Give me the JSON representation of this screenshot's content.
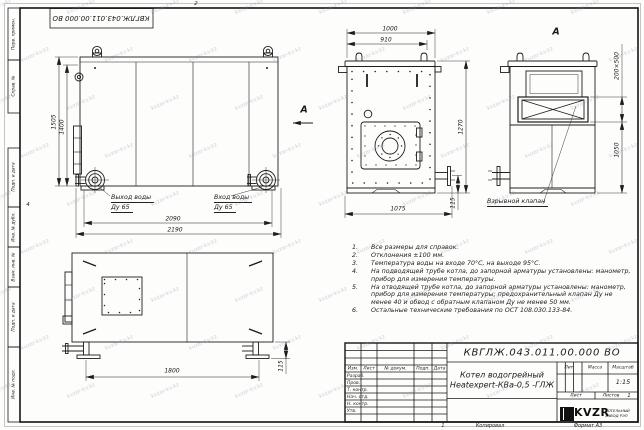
{
  "sheet": {
    "zone_top": "2",
    "zone_left": "4",
    "fold_mark": "1",
    "copy_label": "Копировал",
    "format_label": "Формат А3",
    "stamp_top": "КВГЛЖ.043.011.00.000 ВО",
    "watermark": "kvzar-kv.kz"
  },
  "frame_left": {
    "boxes_top": [
      "Перв. примен.",
      "Справ. №"
    ],
    "boxes_bottom": [
      "Подп. и дата",
      "Инв. № дубл.",
      "Взам. инв. №",
      "Подп. и дата",
      "Инв. № подл."
    ]
  },
  "views": {
    "side_top": {
      "dim_height_outer": "1505",
      "dim_height_inner": "1400",
      "dim_width_inner": "2090",
      "dim_width_outer": "2190",
      "outlet_label": "Выход воды",
      "outlet_dn": "Ду 65",
      "inlet_label": "Вход воды",
      "inlet_dn": "Ду 65",
      "section_arrow": "А"
    },
    "front": {
      "dim_top_outer": "1000",
      "dim_top_inner": "910",
      "dim_height": "1270",
      "dim_bottom": "1075",
      "dim_pipe": "115"
    },
    "rear": {
      "view_label": "А",
      "dim_valve": "200×500",
      "dim_height": "1050",
      "valve_callout": "Взрывной клапан"
    },
    "side_bottom": {
      "dim_length": "1800",
      "dim_foot": "115"
    }
  },
  "notes": {
    "items": [
      {
        "num": "1.",
        "text": "Все размеры для справок."
      },
      {
        "num": "2.",
        "text": "Отклонения ±100 мм."
      },
      {
        "num": "3.",
        "text": "Температура воды на входе 70°С, на выходе 95°С."
      },
      {
        "num": "4.",
        "text": "На подводящей трубе котла, до запорной арматуры установлены: манометр, прибор для измерения температуры."
      },
      {
        "num": "5.",
        "text": "На отводящей трубе котла, до запорной арматуры установлены: манометр, прибор для измерения температуры; предохранительный клапан Ду не менее 40 и обвод с обратным клапаном Ду не менее 50 мм."
      },
      {
        "num": "6.",
        "text": "Остальные технические требования по ОСТ 108.030.133-84."
      }
    ]
  },
  "title_block": {
    "doc_number": "КВГЛЖ.043.011.00.000 ВО",
    "name_line1": "Котел водогрейный",
    "name_line2": "Heatexpert-КВа-0,5 -ГЛЖ",
    "cols": [
      "Изм.",
      "Лист",
      "№ докум.",
      "Подп.",
      "Дата"
    ],
    "rows": [
      "Разраб.",
      "Пров.",
      "Т. контр.",
      "Нач. отд.",
      "Н. контр.",
      "Утв."
    ],
    "lit_label": "Лит.",
    "mass_label": "Масса",
    "scale_label": "Масштаб",
    "scale_value": "1:15",
    "sheet_label": "Лист",
    "sheets_label": "Листов",
    "sheets_value": "1",
    "logo_text": "KVZR",
    "company_line1": "КОТЕЛЬНЫЙ",
    "company_line2": "ЗАВОД РЭП"
  }
}
